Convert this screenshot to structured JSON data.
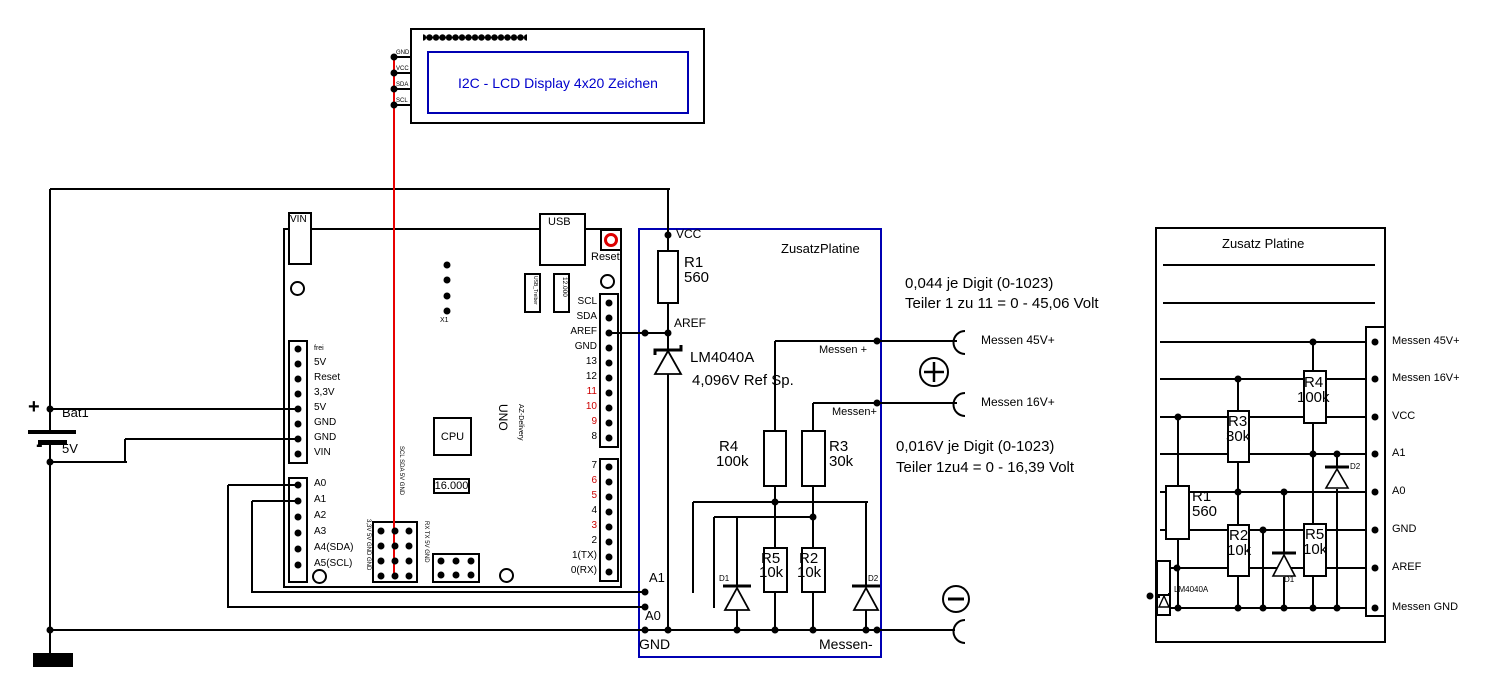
{
  "lcd": {
    "label": "I2C - LCD Display 4x20 Zeichen",
    "pins": [
      "GND",
      "VCC",
      "SDA",
      "SCL"
    ]
  },
  "battery": {
    "plus": "+",
    "minus": "-",
    "name": "Bat1",
    "voltage": "5V"
  },
  "arduino": {
    "vin_label": "VIN",
    "usb_label": "USB",
    "reset_label": "Reset",
    "x1_label": "X1",
    "usb_chip_label": "USB_Treiber",
    "usb_crystal_label": "12.000",
    "cpu_label": "CPU",
    "crystal_label": "16.000",
    "uno_label": "UNO",
    "brand_label": "AZ-Delivery",
    "power_pins": [
      "frei",
      "5V",
      "Reset",
      "3,3V",
      "5V",
      "GND",
      "GND",
      "VIN"
    ],
    "analog_pins": [
      "A0",
      "A1",
      "A2",
      "A3",
      "A4(SDA)",
      "A5(SCL)"
    ],
    "digital_pins_top": [
      "SCL",
      "SDA",
      "AREF",
      "GND",
      "13",
      "12",
      "11",
      "10",
      "9",
      "8"
    ],
    "digital_pins_bottom": [
      "7",
      "6",
      "5",
      "4",
      "3",
      "2",
      "1(TX)",
      "0(RX)"
    ],
    "icsp_label_left": "3,3V 5V GND GND",
    "icsp_label_top": "SCL SDA 5V GND",
    "icsp_label_right": "RX TX 5V GND"
  },
  "zusatzplatine": {
    "title": "ZusatzPlatine",
    "vcc": "VCC",
    "aref": "AREF",
    "a1": "A1",
    "a0": "A0",
    "gnd": "GND",
    "messen_minus": "Messen-",
    "messen_plus_45": "Messen +",
    "messen_plus_16": "Messen+",
    "r1_name": "R1",
    "r1_value": "560",
    "r4_name": "R4",
    "r4_value": "100k",
    "r3_name": "R3",
    "r3_value": "30k",
    "r5_name": "R5",
    "r5_value": "10k",
    "r2_name": "R2",
    "r2_value": "10k",
    "d1": "D1",
    "d2": "D2",
    "vref_name": "LM4040A",
    "vref_value": "4,096V Ref Sp."
  },
  "notes": {
    "note45_line1": "0,044 je Digit (0-1023)",
    "note45_line2": "Teiler 1 zu 11 = 0 - 45,06 Volt",
    "note16_line1": "0,016V je Digit (0-1023)",
    "note16_line2": "Teiler 1zu4 = 0 - 16,39 Volt"
  },
  "terminals": {
    "messen45": "Messen 45V+",
    "messen16": "Messen 16V+"
  },
  "layout_board": {
    "title": "Zusatz Platine",
    "pins": [
      "Messen 45V+",
      "Messen 16V+",
      "VCC",
      "A1",
      "A0",
      "GND",
      "AREF",
      "Messen GND"
    ],
    "r1_name": "R1",
    "r1_value": "560",
    "r2_name": "R2",
    "r2_value": "10k",
    "r3_name": "R3",
    "r3_value": "30k",
    "r4_name": "R4",
    "r4_value": "100k",
    "r5_name": "R5",
    "r5_value": "10k",
    "d1": "D1",
    "d2": "D2",
    "vref": "LM4040A"
  },
  "colors": {
    "wire_red": "#e80000",
    "box_blue": "#0000b3",
    "text_blue": "#0000cc",
    "pin_red": "#cc0000"
  }
}
